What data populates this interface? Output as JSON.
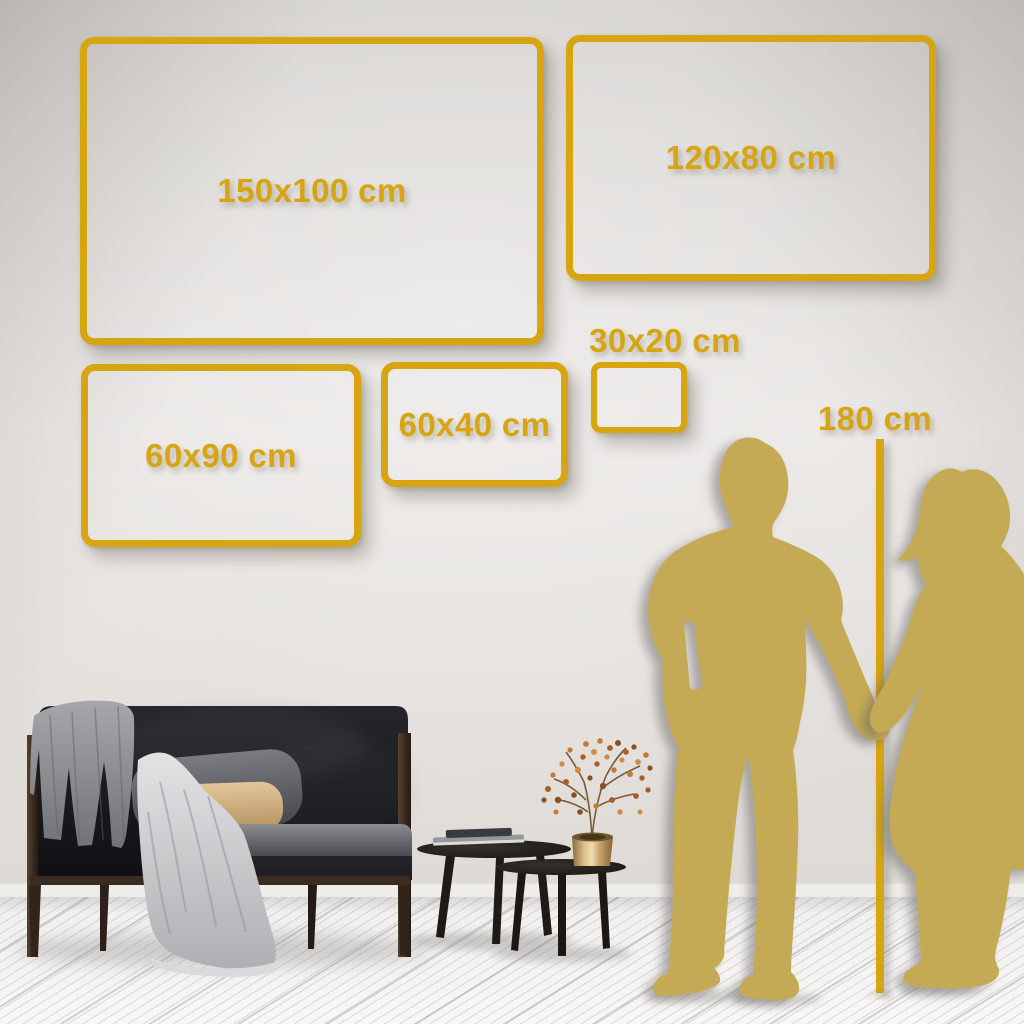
{
  "palette": {
    "gold": "#D7A512",
    "silhouette_gold": "#C5AA55",
    "wall_light": "#E8E5E2",
    "wall_dark": "#D2CFCB",
    "floor": "#F0EFED"
  },
  "frames": [
    {
      "label": "150x100 cm",
      "width_cm": 150,
      "height_cm": 100
    },
    {
      "label": "120x80 cm",
      "width_cm": 120,
      "height_cm": 80
    },
    {
      "label": "60x90 cm",
      "width_cm": 60,
      "height_cm": 90
    },
    {
      "label": "60x40 cm",
      "width_cm": 60,
      "height_cm": 40
    },
    {
      "label": "30x20 cm",
      "width_cm": 30,
      "height_cm": 20
    }
  ],
  "height_marker": {
    "label": "180 cm",
    "height_cm": 180
  },
  "scene": {
    "figures": [
      "man-silhouette",
      "woman-silhouette"
    ],
    "furniture": [
      "dark-sofa",
      "gray-blanket",
      "white-throw",
      "nesting-coffee-tables",
      "books",
      "brass-vase",
      "dried-flower-branch"
    ]
  }
}
